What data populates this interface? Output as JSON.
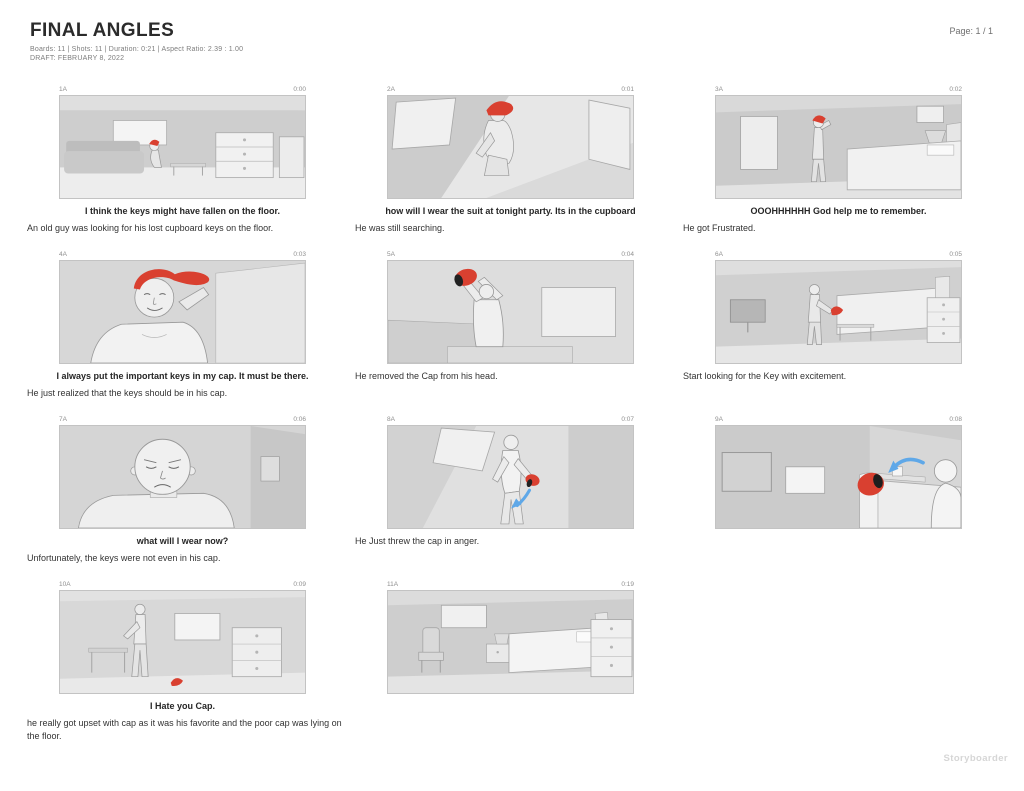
{
  "header": {
    "title": "FINAL ANGLES",
    "meta": "Boards: 11  |  Shots: 11  |  Duration: 0:21  |  Aspect Ratio: 2.39 : 1.00",
    "draft": "DRAFT: FEBRUARY 8, 2022",
    "page": "Page: 1 / 1"
  },
  "watermark": "Storyboarder",
  "colors": {
    "cap_red": "#d94030",
    "arrow_blue": "#5fa8e8",
    "text_dark": "#2b2b2b",
    "muted_gray": "#8f8f8f",
    "watermark_gray": "#d6d6d6"
  },
  "boards": [
    {
      "shot": "1A",
      "time": "0:00",
      "dialogue": "I think the keys might have fallen on the floor.",
      "action": "An old guy was looking for his lost cupboard keys on the floor."
    },
    {
      "shot": "2A",
      "time": "0:01",
      "dialogue": "how will I wear the suit at tonight party. Its in the cupboard",
      "action": "He was still searching."
    },
    {
      "shot": "3A",
      "time": "0:02",
      "dialogue": "OOOHHHHHH God help me to remember.",
      "action": "He got Frustrated."
    },
    {
      "shot": "4A",
      "time": "0:03",
      "dialogue": "I always put the important keys in my cap. It must be there.",
      "action": "He just realized that the keys should be in his cap."
    },
    {
      "shot": "5A",
      "time": "0:04",
      "dialogue": "",
      "action": "He removed the Cap from his head."
    },
    {
      "shot": "6A",
      "time": "0:05",
      "dialogue": "",
      "action": "Start looking for the Key with excitement."
    },
    {
      "shot": "7A",
      "time": "0:06",
      "dialogue": "what will I  wear now?",
      "action": "Unfortunately, the keys were not even in his cap."
    },
    {
      "shot": "8A",
      "time": "0:07",
      "dialogue": "",
      "action": "He Just threw the cap in anger."
    },
    {
      "shot": "9A",
      "time": "0:08",
      "dialogue": "",
      "action": ""
    },
    {
      "shot": "10A",
      "time": "0:09",
      "dialogue": "I Hate you Cap.",
      "action": "he really got upset with cap as it was his favorite and the poor cap was lying on the floor."
    },
    {
      "shot": "11A",
      "time": "0:19",
      "dialogue": "",
      "action": ""
    }
  ]
}
